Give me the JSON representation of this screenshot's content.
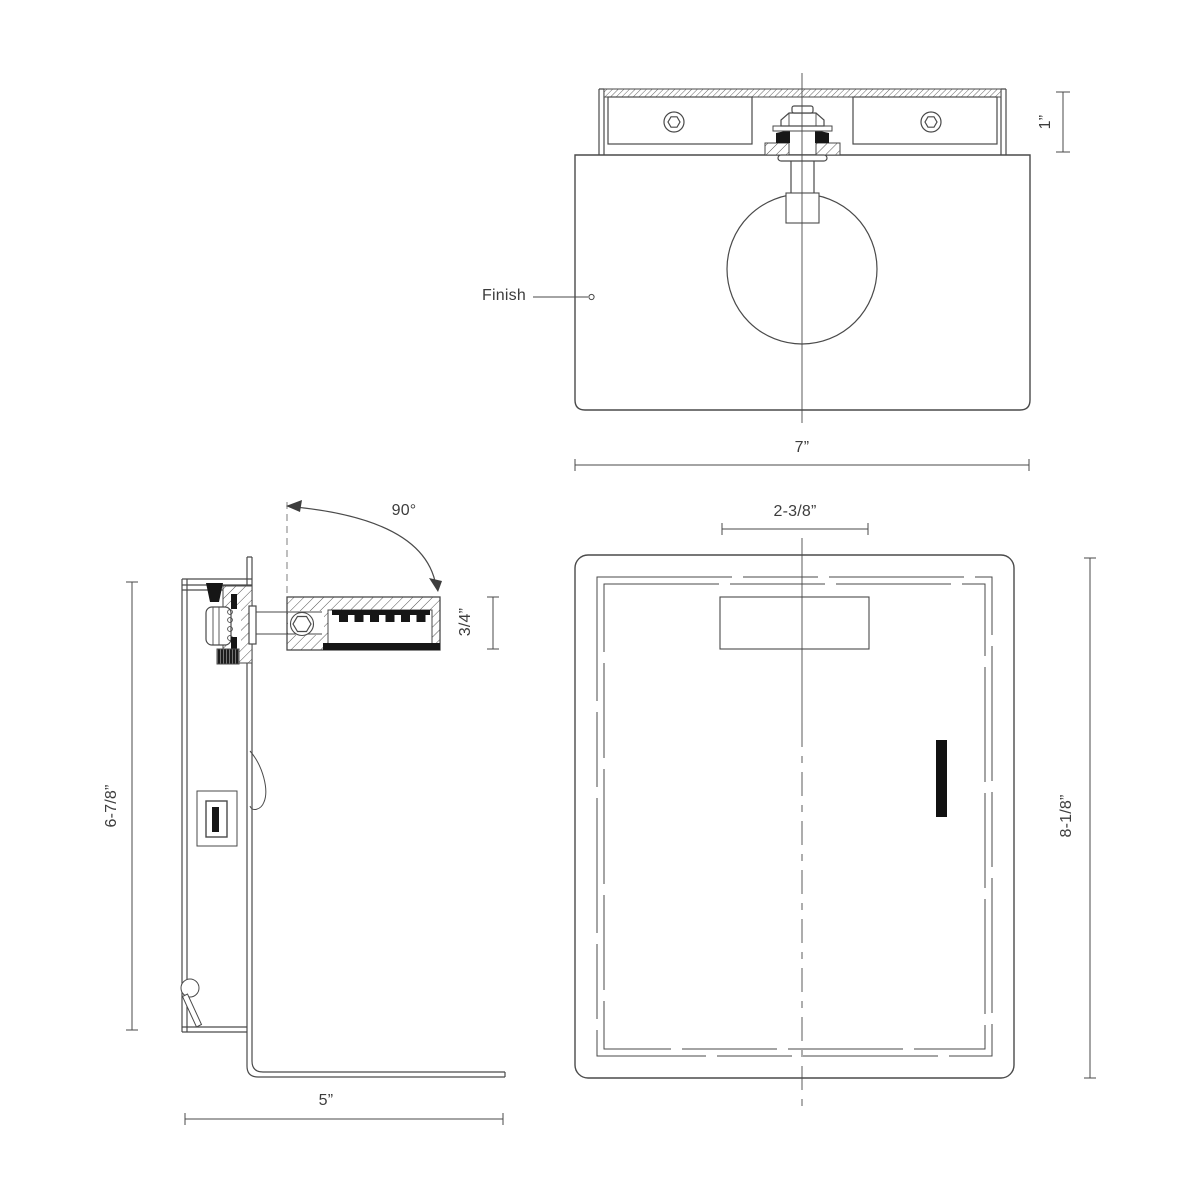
{
  "palette": {
    "line_color": "#4a4a4a",
    "text_color": "#3d3d3d",
    "solid_fill": "#161616",
    "background": "#ffffff"
  },
  "views": {
    "front": {
      "finish_label": "Finish",
      "bracket_height_dim": "1”",
      "width_dim": "7”"
    },
    "side": {
      "swivel_angle_dim": "90°",
      "light_bar_thickness_dim": "3/4”",
      "height_dim": "6-7/8”",
      "depth_dim": "5”"
    },
    "back": {
      "knockout_width_dim": "2-3/8”",
      "height_dim": "8-1/8”"
    }
  }
}
